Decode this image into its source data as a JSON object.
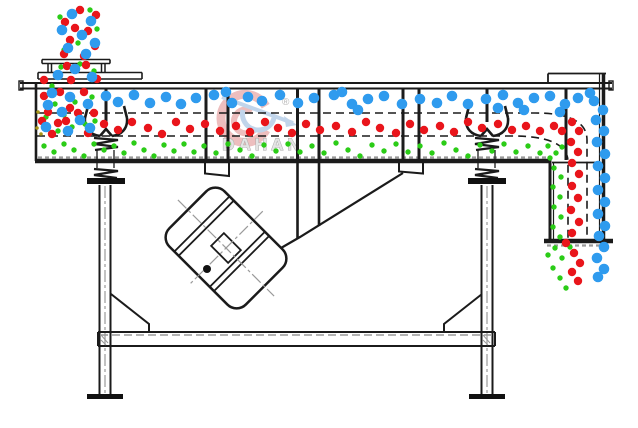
{
  "watermark": {
    "brand": "DAHAN",
    "registered": "®"
  },
  "colors": {
    "background": "#ffffff",
    "line": "#1b1b1b",
    "hatch_gray": "#9a9a9a",
    "blue": "#2f9bee",
    "red": "#e9151b",
    "green": "#2bcc17",
    "yellow": "#a89617",
    "watermark_red": "#e08a8a",
    "watermark_blue": "#8fb3dc",
    "watermark_text": "#e4e4e4",
    "watermark_text_outline": "#ababab"
  },
  "particles": {
    "blue": {
      "r": 5.3,
      "color": "#2f9bee",
      "points": [
        [
          72,
          14
        ],
        [
          91,
          21
        ],
        [
          62,
          30
        ],
        [
          82,
          35
        ],
        [
          95,
          43
        ],
        [
          68,
          48
        ],
        [
          86,
          54
        ],
        [
          75,
          69
        ],
        [
          58,
          75
        ],
        [
          92,
          77
        ],
        [
          52,
          93
        ],
        [
          70,
          97
        ],
        [
          106,
          96
        ],
        [
          88,
          104
        ],
        [
          48,
          105
        ],
        [
          62,
          112
        ],
        [
          80,
          120
        ],
        [
          46,
          127
        ],
        [
          68,
          131
        ],
        [
          90,
          128
        ],
        [
          118,
          102
        ],
        [
          134,
          95
        ],
        [
          150,
          103
        ],
        [
          166,
          97
        ],
        [
          181,
          104
        ],
        [
          196,
          98
        ],
        [
          214,
          95
        ],
        [
          226,
          92
        ],
        [
          232,
          103
        ],
        [
          248,
          97
        ],
        [
          262,
          101
        ],
        [
          280,
          95
        ],
        [
          298,
          103
        ],
        [
          314,
          98
        ],
        [
          334,
          95
        ],
        [
          342,
          92
        ],
        [
          352,
          104
        ],
        [
          358,
          110
        ],
        [
          368,
          99
        ],
        [
          384,
          96
        ],
        [
          402,
          104
        ],
        [
          420,
          99
        ],
        [
          437,
          103
        ],
        [
          452,
          96
        ],
        [
          468,
          104
        ],
        [
          486,
          99
        ],
        [
          498,
          108
        ],
        [
          503,
          95
        ],
        [
          518,
          103
        ],
        [
          524,
          110
        ],
        [
          534,
          98
        ],
        [
          550,
          96
        ],
        [
          560,
          112
        ],
        [
          565,
          104
        ],
        [
          578,
          98
        ],
        [
          590,
          93
        ],
        [
          594,
          101
        ],
        [
          603,
          110
        ],
        [
          596,
          120
        ],
        [
          604,
          131
        ],
        [
          597,
          142
        ],
        [
          605,
          154
        ],
        [
          598,
          166
        ],
        [
          605,
          178
        ],
        [
          598,
          190
        ],
        [
          605,
          202
        ],
        [
          598,
          214
        ],
        [
          605,
          226
        ],
        [
          599,
          236
        ],
        [
          604,
          247
        ],
        [
          597,
          258
        ],
        [
          604,
          269
        ],
        [
          598,
          277
        ]
      ]
    },
    "red": {
      "r": 4.2,
      "color": "#e9151b",
      "points": [
        [
          80,
          10
        ],
        [
          96,
          15
        ],
        [
          65,
          22
        ],
        [
          75,
          28
        ],
        [
          88,
          31
        ],
        [
          70,
          40
        ],
        [
          95,
          46
        ],
        [
          64,
          54
        ],
        [
          84,
          56
        ],
        [
          67,
          66
        ],
        [
          86,
          65
        ],
        [
          97,
          79
        ],
        [
          71,
          80
        ],
        [
          44,
          80
        ],
        [
          44,
          96
        ],
        [
          60,
          92
        ],
        [
          84,
          92
        ],
        [
          48,
          112
        ],
        [
          70,
          108
        ],
        [
          94,
          113
        ],
        [
          42,
          121
        ],
        [
          58,
          123
        ],
        [
          78,
          113
        ],
        [
          88,
          133
        ],
        [
          52,
          134
        ],
        [
          66,
          121
        ],
        [
          104,
          124
        ],
        [
          118,
          130
        ],
        [
          132,
          122
        ],
        [
          148,
          128
        ],
        [
          162,
          134
        ],
        [
          176,
          122
        ],
        [
          190,
          129
        ],
        [
          205,
          124
        ],
        [
          220,
          131
        ],
        [
          236,
          126
        ],
        [
          250,
          132
        ],
        [
          265,
          122
        ],
        [
          278,
          128
        ],
        [
          292,
          133
        ],
        [
          306,
          124
        ],
        [
          320,
          130
        ],
        [
          336,
          126
        ],
        [
          352,
          132
        ],
        [
          366,
          122
        ],
        [
          380,
          128
        ],
        [
          396,
          133
        ],
        [
          410,
          124
        ],
        [
          424,
          130
        ],
        [
          440,
          126
        ],
        [
          454,
          132
        ],
        [
          468,
          122
        ],
        [
          482,
          128
        ],
        [
          498,
          124
        ],
        [
          512,
          130
        ],
        [
          526,
          126
        ],
        [
          540,
          131
        ],
        [
          554,
          126
        ],
        [
          562,
          131
        ],
        [
          572,
          122
        ],
        [
          579,
          131
        ],
        [
          571,
          142
        ],
        [
          578,
          152
        ],
        [
          572,
          163
        ],
        [
          579,
          174
        ],
        [
          572,
          186
        ],
        [
          578,
          198
        ],
        [
          571,
          210
        ],
        [
          579,
          222
        ],
        [
          572,
          233
        ],
        [
          566,
          243
        ],
        [
          574,
          253
        ],
        [
          580,
          263
        ],
        [
          572,
          272
        ],
        [
          578,
          281
        ]
      ]
    },
    "green": {
      "r": 2.7,
      "color": "#2bcc17",
      "points": [
        [
          90,
          10
        ],
        [
          60,
          17
        ],
        [
          97,
          29
        ],
        [
          78,
          43
        ],
        [
          64,
          50
        ],
        [
          80,
          64
        ],
        [
          61,
          67
        ],
        [
          94,
          71
        ],
        [
          52,
          86
        ],
        [
          55,
          104
        ],
        [
          75,
          102
        ],
        [
          92,
          97
        ],
        [
          46,
          117
        ],
        [
          64,
          115
        ],
        [
          85,
          124
        ],
        [
          58,
          131
        ],
        [
          72,
          127
        ],
        [
          95,
          121
        ],
        [
          44,
          146
        ],
        [
          54,
          152
        ],
        [
          64,
          144
        ],
        [
          74,
          150
        ],
        [
          84,
          156
        ],
        [
          94,
          144
        ],
        [
          104,
          150
        ],
        [
          114,
          146
        ],
        [
          124,
          153
        ],
        [
          134,
          143
        ],
        [
          144,
          150
        ],
        [
          154,
          156
        ],
        [
          164,
          145
        ],
        [
          174,
          151
        ],
        [
          184,
          144
        ],
        [
          194,
          152
        ],
        [
          204,
          146
        ],
        [
          216,
          153
        ],
        [
          228,
          144
        ],
        [
          240,
          150
        ],
        [
          252,
          156
        ],
        [
          264,
          145
        ],
        [
          276,
          151
        ],
        [
          288,
          144
        ],
        [
          300,
          152
        ],
        [
          312,
          146
        ],
        [
          324,
          153
        ],
        [
          336,
          143
        ],
        [
          348,
          150
        ],
        [
          360,
          156
        ],
        [
          372,
          145
        ],
        [
          384,
          151
        ],
        [
          396,
          144
        ],
        [
          408,
          152
        ],
        [
          420,
          146
        ],
        [
          432,
          153
        ],
        [
          444,
          143
        ],
        [
          456,
          150
        ],
        [
          468,
          156
        ],
        [
          480,
          145
        ],
        [
          492,
          151
        ],
        [
          504,
          144
        ],
        [
          516,
          152
        ],
        [
          528,
          146
        ],
        [
          540,
          153
        ],
        [
          548,
          146
        ],
        [
          556,
          153
        ],
        [
          562,
          147
        ],
        [
          550,
          158
        ],
        [
          554,
          168
        ],
        [
          561,
          177
        ],
        [
          553,
          187
        ],
        [
          560,
          197
        ],
        [
          554,
          207
        ],
        [
          561,
          217
        ],
        [
          553,
          227
        ],
        [
          560,
          237
        ],
        [
          555,
          248
        ],
        [
          562,
          258
        ],
        [
          553,
          268
        ],
        [
          560,
          278
        ],
        [
          566,
          288
        ],
        [
          548,
          255
        ],
        [
          570,
          247
        ]
      ]
    },
    "yellow": {
      "r": 1.8,
      "color": "#a89617",
      "points": [
        [
          38,
          112
        ],
        [
          42,
          120
        ],
        [
          37,
          128
        ],
        [
          41,
          134
        ]
      ]
    }
  }
}
